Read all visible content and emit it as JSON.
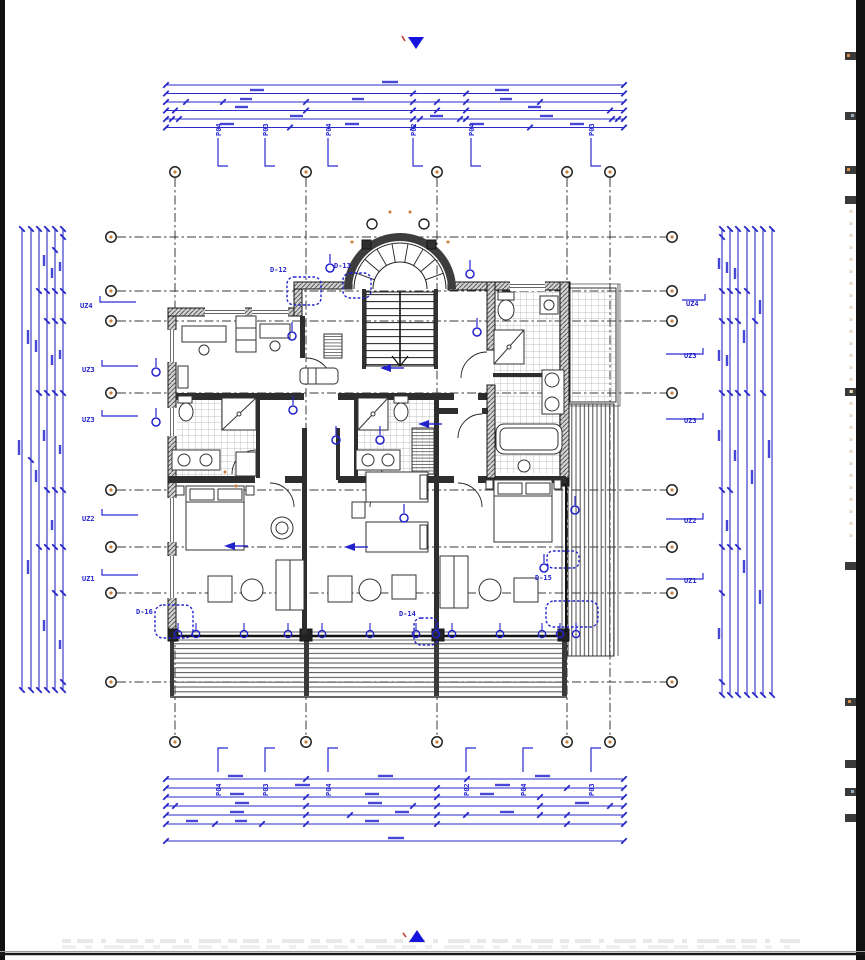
{
  "annotations": {
    "section_marker_top": "▼",
    "section_marker_bottom": "▲"
  },
  "detail_callouts": {
    "d12": "D-12",
    "d13": "D-13",
    "d14": "D-14",
    "d15": "D-15",
    "d16": "D-16"
  },
  "uz_labels": {
    "left": [
      "UZ4",
      "UZ3",
      "UZ3",
      "UZ2",
      "UZ1"
    ],
    "right": [
      "UZ4",
      "UZ3",
      "UZ3",
      "UZ2",
      "UZ1"
    ]
  },
  "po_labels": {
    "top": [
      "P04",
      "P03",
      "P04",
      "P02",
      "P04",
      "P03"
    ],
    "bottom": [
      "P04",
      "P03",
      "P04",
      "P02",
      "P04",
      "P03"
    ]
  },
  "colors": {
    "annotation_blue": "#2323cc",
    "dimension_blue": "#3333cc",
    "wall_dark": "#2b2b2b",
    "tile_gray": "#adadad",
    "accent_orange": "#c9803d"
  }
}
